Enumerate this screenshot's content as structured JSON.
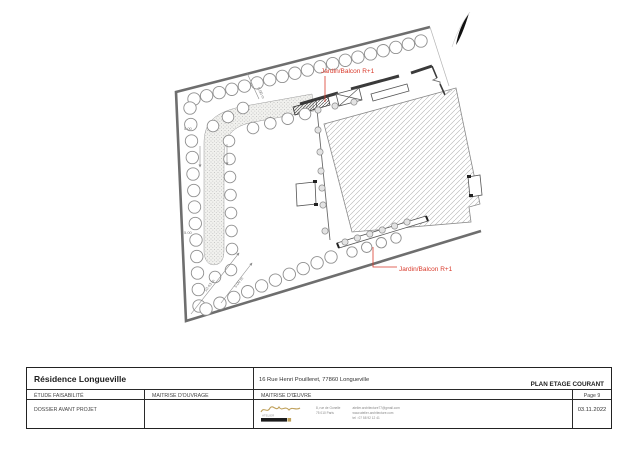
{
  "plan": {
    "labels": {
      "jardin_balcon_top": "Jardin/Balcon R+1",
      "jardin_balcon_bottom": "Jardin/Balcon R+1"
    },
    "dimensions": {
      "left_upper": "5.00",
      "left_lower": "5.00",
      "top_diagonal": "5.00 m",
      "corner_long": "10.43 m",
      "corner_short": "5.00 m"
    }
  },
  "title_block": {
    "project_name": "Résidence Longueville",
    "project_address": "16 Rue Henri Pouilleret, 77860 Longueville",
    "drawing_title": "PLAN ETAGE COURANT",
    "study_label": "ÉTUDE FAISABILITÉ",
    "owner_label": "MAITRISE D'OUVRAGE",
    "architect_label": "MAITRISE D'ŒUVRE",
    "page_label": "Page 9",
    "phase_label": "DOSSIER AVANT PROJET",
    "date": "03.11.2022",
    "firm": {
      "logo_text": "ATELIER",
      "address_line1": "8, rue de Gonelle",
      "address_line2": "75 010 Paris",
      "email": "atelier.architecture77@gmail.com",
      "website": "www.atelier-architecture.com",
      "phone": "tel : 07 58 92 12 41"
    }
  },
  "colors": {
    "accent_red": "#d93a2b",
    "logo_gold": "#bfa05a"
  }
}
